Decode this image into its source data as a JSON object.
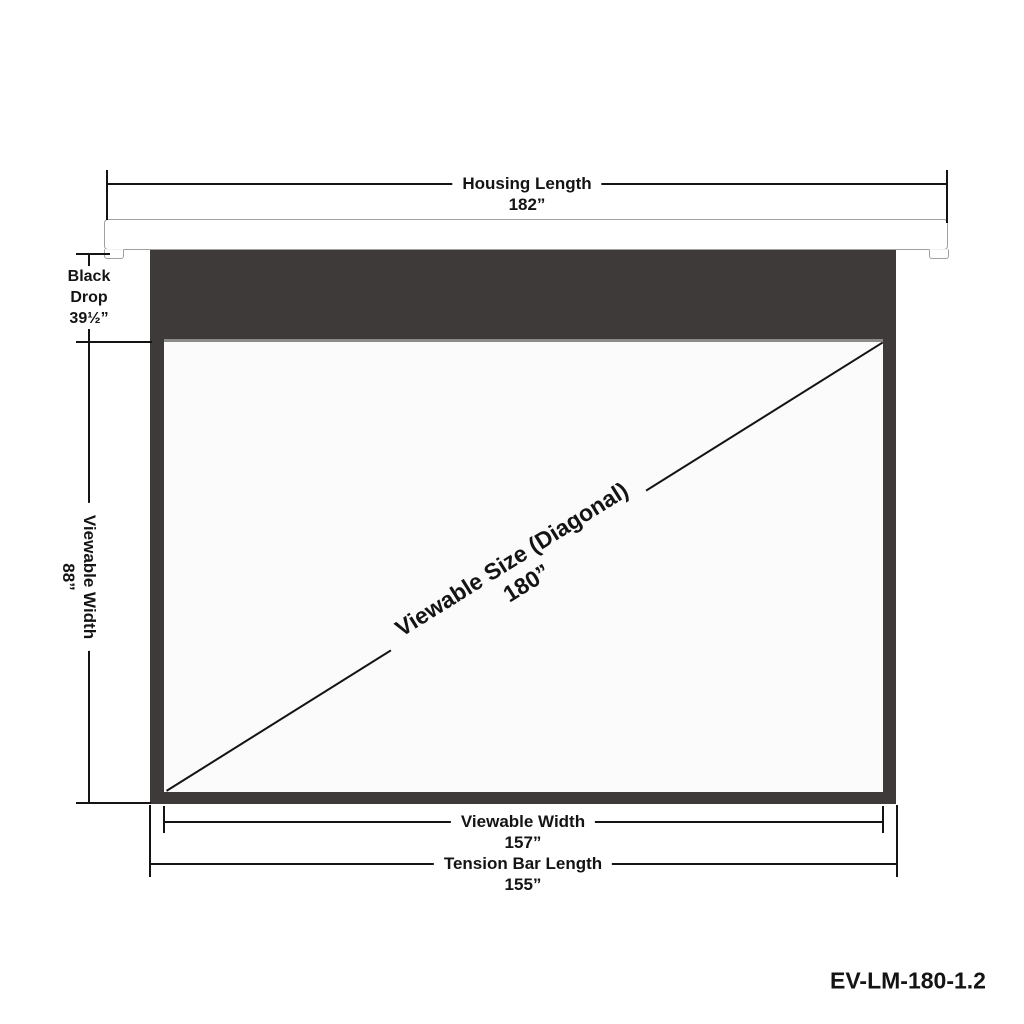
{
  "product_code": "EV-LM-180-1.2",
  "dimensions": {
    "housing_length": {
      "label": "Housing Length",
      "value": "182”"
    },
    "black_drop": {
      "line1": "Black",
      "line2": "Drop",
      "value": "39½”"
    },
    "viewable_height": {
      "label": "Viewable Width",
      "value": "88”"
    },
    "diagonal": {
      "label": "Viewable Size (Diagonal)",
      "value": "180”"
    },
    "viewable_width_bottom": {
      "label": "Viewable Width",
      "value": "157”"
    },
    "tension_bar": {
      "label": "Tension Bar Length",
      "value": "155”"
    }
  },
  "colors": {
    "case_dark": "#3E3A3A",
    "screen_white": "#FBFBFB",
    "divider_gray": "#8D8B89",
    "housing_outline": "#A0A09E",
    "dimension_line": "#141414"
  }
}
